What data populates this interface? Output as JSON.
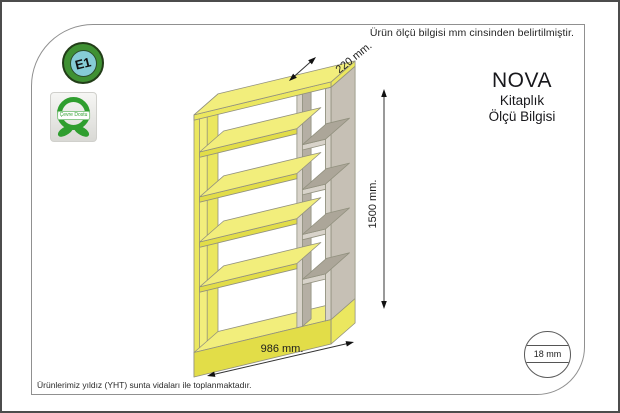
{
  "notes": {
    "top": "Ürün ölçü bilgisi mm cinsinden belirtilmiştir.",
    "footer": "Ürünlerimiz yıldız (YHT) sunta vidaları ile toplanmaktadır."
  },
  "badges": {
    "e1": "E1",
    "eco": "Çevre Dostu"
  },
  "title_block": {
    "name": "NOVA",
    "type": "Kitaplık",
    "subtitle": "Ölçü Bilgisi"
  },
  "dimensions": {
    "depth": "220 mm.",
    "height": "1500 mm.",
    "width": "986 mm.",
    "thickness": "18 mm"
  },
  "colors": {
    "shelf_yellow": "#f2ee7c",
    "shelf_yellow_mid": "#ebe75f",
    "shelf_yellow_dark": "#e2dd48",
    "shelf_gray": "#b5afa4",
    "shelf_gray_light": "#d8d3ca",
    "shelf_gray_top": "#aca699",
    "shelf_gray_outer": "#c6c0b5",
    "outline": "#92917f",
    "dim_line": "#333333",
    "e1_green": "#3f9133",
    "e1_blue": "#86ccd6",
    "eco_green": "#2f9e2f"
  }
}
